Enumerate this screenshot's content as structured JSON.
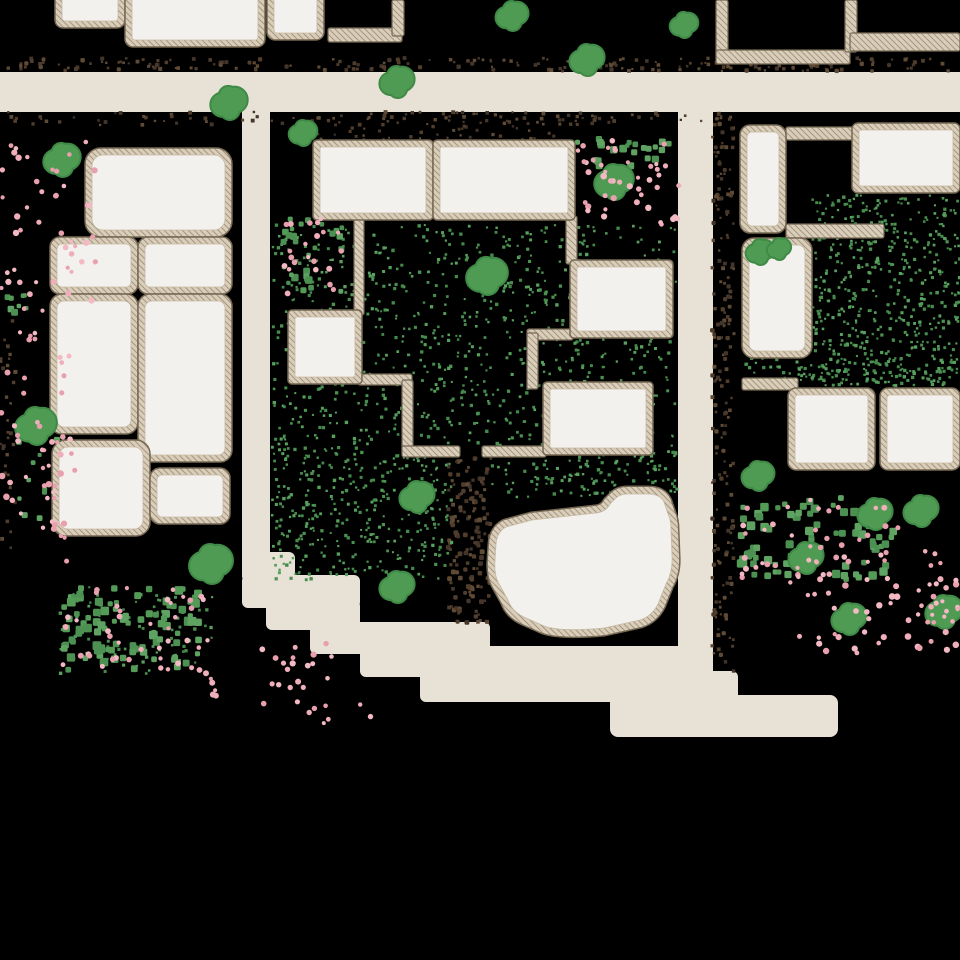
{
  "scene": {
    "name": "pixel-village-map",
    "width": 960,
    "height": 960
  },
  "colors": {
    "background": "#000000",
    "road": "#e8e1d6",
    "floor": "#f2f1ed",
    "wall_fill": "#d9cebc",
    "wall_hatch": "#a6967b",
    "wall_outline": "#75685345",
    "wall_edge": "#756853",
    "floor_edge": "#c6b9a3",
    "tree_fill": "#4f9b53",
    "tree_edge": "#3f8a46",
    "palettes": {
      "dirt": [
        "#503d2b",
        "#5e4a35",
        "#44352a"
      ],
      "grass": [
        "#4d9152",
        "#448a4b",
        "#58a05d"
      ],
      "bush": [
        "#559b58",
        "#4d9152",
        "#5fa363"
      ],
      "flower": [
        "#efaeb9",
        "#e9a0ae",
        "#f3bac4"
      ]
    }
  },
  "roads": [
    {
      "x": 0,
      "y": 72,
      "w": 960,
      "h": 40,
      "rx": 0
    },
    {
      "x": 242,
      "y": 108,
      "w": 28,
      "h": 452,
      "rx": 0
    },
    {
      "x": 678,
      "y": 108,
      "w": 35,
      "h": 570,
      "rx": 0
    },
    {
      "x": 242,
      "y": 552,
      "w": 53,
      "h": 30,
      "rx": 6
    },
    {
      "x": 242,
      "y": 575,
      "w": 118,
      "h": 33,
      "rx": 6
    },
    {
      "x": 266,
      "y": 600,
      "w": 94,
      "h": 30,
      "rx": 6
    },
    {
      "x": 310,
      "y": 622,
      "w": 180,
      "h": 32,
      "rx": 6
    },
    {
      "x": 360,
      "y": 646,
      "w": 353,
      "h": 31,
      "rx": 6
    },
    {
      "x": 420,
      "y": 671,
      "w": 318,
      "h": 31,
      "rx": 6
    },
    {
      "x": 610,
      "y": 695,
      "w": 228,
      "h": 42,
      "rx": 8
    }
  ],
  "rooms": [
    {
      "x": 55,
      "y": -20,
      "w": 70,
      "h": 48,
      "rx": 8
    },
    {
      "x": 125,
      "y": -20,
      "w": 140,
      "h": 67,
      "rx": 8
    },
    {
      "x": 267,
      "y": -20,
      "w": 57,
      "h": 60,
      "rx": 8
    },
    {
      "x": 85,
      "y": 148,
      "w": 147,
      "h": 89,
      "rx": 16
    },
    {
      "x": 50,
      "y": 237,
      "w": 88,
      "h": 57,
      "rx": 10
    },
    {
      "x": 50,
      "y": 294,
      "w": 88,
      "h": 140,
      "rx": 12
    },
    {
      "x": 138,
      "y": 237,
      "w": 94,
      "h": 57,
      "rx": 10
    },
    {
      "x": 138,
      "y": 294,
      "w": 94,
      "h": 168,
      "rx": 12
    },
    {
      "x": 52,
      "y": 440,
      "w": 98,
      "h": 96,
      "rx": 14
    },
    {
      "x": 150,
      "y": 468,
      "w": 80,
      "h": 56,
      "rx": 10
    },
    {
      "x": 313,
      "y": 140,
      "w": 120,
      "h": 80,
      "rx": 4
    },
    {
      "x": 433,
      "y": 140,
      "w": 142,
      "h": 80,
      "rx": 4
    },
    {
      "x": 570,
      "y": 260,
      "w": 103,
      "h": 78,
      "rx": 4
    },
    {
      "x": 543,
      "y": 382,
      "w": 110,
      "h": 73,
      "rx": 4
    },
    {
      "x": 288,
      "y": 310,
      "w": 74,
      "h": 74,
      "rx": 4
    },
    {
      "x": 740,
      "y": 125,
      "w": 46,
      "h": 108,
      "rx": 10
    },
    {
      "x": 852,
      "y": 123,
      "w": 108,
      "h": 70,
      "rx": 6
    },
    {
      "x": 742,
      "y": 238,
      "w": 70,
      "h": 120,
      "rx": 12
    },
    {
      "x": 788,
      "y": 388,
      "w": 87,
      "h": 82,
      "rx": 8
    },
    {
      "x": 880,
      "y": 388,
      "w": 80,
      "h": 82,
      "rx": 8
    }
  ],
  "walls": [
    {
      "x": 354,
      "y": 218,
      "w": 10,
      "h": 97
    },
    {
      "x": 358,
      "y": 374,
      "w": 54,
      "h": 11
    },
    {
      "x": 402,
      "y": 380,
      "w": 11,
      "h": 75
    },
    {
      "x": 402,
      "y": 446,
      "w": 58,
      "h": 11
    },
    {
      "x": 482,
      "y": 446,
      "w": 64,
      "h": 11
    },
    {
      "x": 566,
      "y": 216,
      "w": 11,
      "h": 48
    },
    {
      "x": 527,
      "y": 329,
      "w": 46,
      "h": 11
    },
    {
      "x": 527,
      "y": 333,
      "w": 11,
      "h": 56
    },
    {
      "x": 328,
      "y": 28,
      "w": 74,
      "h": 14
    },
    {
      "x": 392,
      "y": 0,
      "w": 12,
      "h": 36
    },
    {
      "x": 716,
      "y": 0,
      "w": 12,
      "h": 62
    },
    {
      "x": 716,
      "y": 50,
      "w": 134,
      "h": 14
    },
    {
      "x": 845,
      "y": 0,
      "w": 12,
      "h": 52
    },
    {
      "x": 850,
      "y": 33,
      "w": 110,
      "h": 18
    },
    {
      "x": 786,
      "y": 127,
      "w": 70,
      "h": 13
    },
    {
      "x": 786,
      "y": 224,
      "w": 98,
      "h": 14
    },
    {
      "x": 742,
      "y": 378,
      "w": 56,
      "h": 12
    }
  ],
  "blob_building": {
    "path": "M 532,520 L 596,513 Q 606,512 610,504 L 616,498 Q 620,494 628,494 L 648,494 Q 660,494 664,502 L 668,514 Q 671,520 671,530 L 672,556 Q 673,572 666,584 L 658,604 Q 652,616 640,620 L 604,628 Q 560,632 544,626 L 526,618 Q 512,612 508,600 L 498,582 Q 494,574 495,560 L 496,544 Q 497,532 506,527 Z"
  },
  "trees": [
    {
      "x": 229,
      "y": 103,
      "r": 17
    },
    {
      "x": 397,
      "y": 82,
      "r": 16
    },
    {
      "x": 512,
      "y": 16,
      "r": 15
    },
    {
      "x": 587,
      "y": 60,
      "r": 16
    },
    {
      "x": 684,
      "y": 25,
      "r": 13
    },
    {
      "x": 62,
      "y": 160,
      "r": 17
    },
    {
      "x": 303,
      "y": 133,
      "r": 13
    },
    {
      "x": 36,
      "y": 426,
      "r": 19
    },
    {
      "x": 487,
      "y": 276,
      "r": 19
    },
    {
      "x": 417,
      "y": 497,
      "r": 16
    },
    {
      "x": 397,
      "y": 587,
      "r": 16
    },
    {
      "x": 211,
      "y": 564,
      "r": 20
    },
    {
      "x": 614,
      "y": 182,
      "r": 18
    },
    {
      "x": 760,
      "y": 252,
      "r": 13
    },
    {
      "x": 779,
      "y": 249,
      "r": 11
    },
    {
      "x": 758,
      "y": 476,
      "r": 15
    },
    {
      "x": 875,
      "y": 514,
      "r": 16
    },
    {
      "x": 921,
      "y": 511,
      "r": 16
    },
    {
      "x": 806,
      "y": 558,
      "r": 16
    },
    {
      "x": 849,
      "y": 619,
      "r": 16
    },
    {
      "x": 944,
      "y": 612,
      "r": 17
    }
  ],
  "speckle_regions": [
    {
      "kind": "dirt",
      "shape": "square",
      "x": 4,
      "y": 58,
      "w": 950,
      "h": 13,
      "n": 210,
      "min": 2,
      "max": 4.5
    },
    {
      "kind": "dirt",
      "shape": "square",
      "x": 4,
      "y": 112,
      "w": 700,
      "h": 13,
      "n": 120,
      "min": 2,
      "max": 4
    },
    {
      "kind": "dirt",
      "shape": "square",
      "x": 712,
      "y": 112,
      "w": 22,
      "h": 270,
      "n": 110,
      "min": 2,
      "max": 4.5
    },
    {
      "kind": "dirt",
      "shape": "square",
      "x": 712,
      "y": 385,
      "w": 22,
      "h": 290,
      "n": 85,
      "min": 2,
      "max": 4.5
    },
    {
      "kind": "dirt",
      "shape": "square",
      "x": 448,
      "y": 455,
      "w": 44,
      "h": 170,
      "n": 150,
      "min": 2.5,
      "max": 5
    },
    {
      "kind": "dirt",
      "shape": "square",
      "x": 306,
      "y": 126,
      "w": 260,
      "h": 14,
      "n": 38,
      "min": 2,
      "max": 3.5
    },
    {
      "kind": "dirt",
      "shape": "square",
      "x": 0,
      "y": 320,
      "w": 16,
      "h": 230,
      "n": 34,
      "min": 2,
      "max": 4
    },
    {
      "kind": "grass",
      "shape": "square",
      "x": 272,
      "y": 225,
      "w": 404,
      "h": 230,
      "n": 900,
      "min": 2,
      "max": 3.4
    },
    {
      "kind": "grass",
      "shape": "square",
      "x": 272,
      "y": 455,
      "w": 180,
      "h": 125,
      "n": 340,
      "min": 2,
      "max": 3.4
    },
    {
      "kind": "grass",
      "shape": "square",
      "x": 492,
      "y": 455,
      "w": 186,
      "h": 42,
      "n": 120,
      "min": 2,
      "max": 3.4
    },
    {
      "kind": "grass",
      "shape": "square",
      "x": 812,
      "y": 195,
      "w": 148,
      "h": 190,
      "n": 500,
      "min": 2,
      "max": 3.4
    },
    {
      "kind": "grass",
      "shape": "square",
      "x": 742,
      "y": 358,
      "w": 218,
      "h": 28,
      "n": 110,
      "min": 2,
      "max": 3.4
    },
    {
      "kind": "grass",
      "shape": "square",
      "x": 55,
      "y": 585,
      "w": 160,
      "h": 90,
      "n": 80,
      "min": 2,
      "max": 3.4
    },
    {
      "kind": "bush",
      "shape": "square",
      "x": 62,
      "y": 588,
      "w": 142,
      "h": 82,
      "n": 95,
      "min": 5,
      "max": 9
    },
    {
      "kind": "bush",
      "shape": "square",
      "x": 740,
      "y": 498,
      "w": 158,
      "h": 82,
      "n": 85,
      "min": 5,
      "max": 9
    },
    {
      "kind": "bush",
      "shape": "square",
      "x": 282,
      "y": 218,
      "w": 60,
      "h": 76,
      "n": 28,
      "min": 4,
      "max": 8
    },
    {
      "kind": "bush",
      "shape": "square",
      "x": 576,
      "y": 138,
      "w": 100,
      "h": 28,
      "n": 22,
      "min": 4,
      "max": 8
    },
    {
      "kind": "bush",
      "shape": "square",
      "x": 0,
      "y": 286,
      "w": 28,
      "h": 34,
      "n": 8,
      "min": 4,
      "max": 7
    },
    {
      "kind": "bush",
      "shape": "square",
      "x": 18,
      "y": 440,
      "w": 50,
      "h": 86,
      "n": 12,
      "min": 4,
      "max": 7
    }
  ],
  "flower_regions": [
    {
      "x": 62,
      "y": 588,
      "w": 142,
      "h": 82,
      "n": 42,
      "min": 2.5,
      "max": 4.5
    },
    {
      "x": 740,
      "y": 498,
      "w": 158,
      "h": 82,
      "n": 46,
      "min": 2.5,
      "max": 4.5
    },
    {
      "x": 282,
      "y": 218,
      "w": 60,
      "h": 76,
      "n": 22,
      "min": 2.5,
      "max": 4.5
    },
    {
      "x": 576,
      "y": 138,
      "w": 100,
      "h": 28,
      "n": 14,
      "min": 2.5,
      "max": 4
    },
    {
      "x": 0,
      "y": 140,
      "w": 96,
      "h": 165,
      "n": 46,
      "min": 2.5,
      "max": 5
    },
    {
      "x": 0,
      "y": 305,
      "w": 78,
      "h": 260,
      "n": 40,
      "min": 2.5,
      "max": 5
    },
    {
      "x": 205,
      "y": 640,
      "w": 128,
      "h": 66,
      "n": 26,
      "min": 2.5,
      "max": 5
    },
    {
      "x": 296,
      "y": 698,
      "w": 78,
      "h": 26,
      "n": 8,
      "min": 2,
      "max": 4
    },
    {
      "x": 580,
      "y": 165,
      "w": 100,
      "h": 60,
      "n": 30,
      "min": 2.5,
      "max": 5
    },
    {
      "x": 788,
      "y": 576,
      "w": 172,
      "h": 78,
      "n": 46,
      "min": 2.5,
      "max": 5
    },
    {
      "x": 925,
      "y": 540,
      "w": 35,
      "h": 90,
      "n": 14,
      "min": 2.5,
      "max": 4.5
    },
    {
      "x": 10,
      "y": 440,
      "w": 60,
      "h": 90,
      "n": 14,
      "min": 2.5,
      "max": 4.5
    }
  ]
}
